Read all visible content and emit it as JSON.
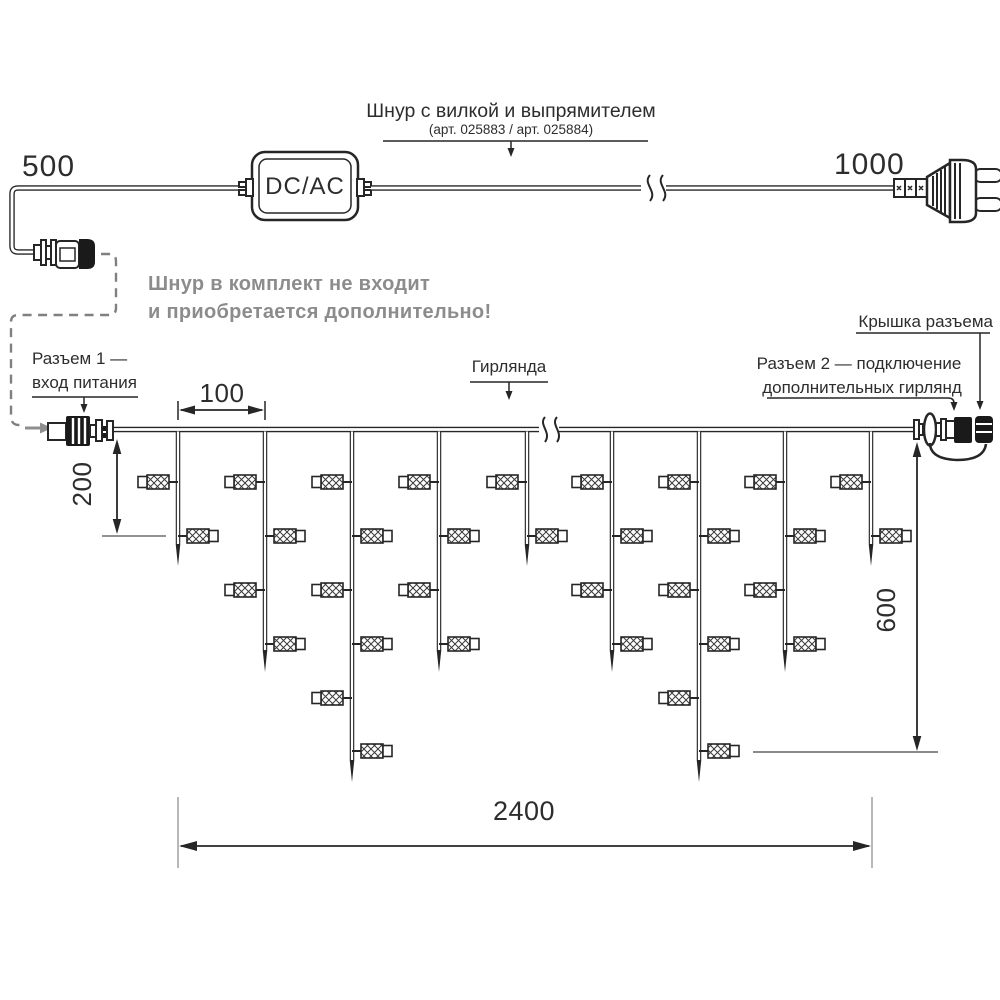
{
  "cord": {
    "dim_left": "500",
    "dim_right": "1000",
    "converter": "DC/AC",
    "title": "Шнур с вилкой и выпрямителем",
    "subtitle": "(арт. 025883 / арт. 025884)",
    "note_line1": "Шнур в комплект не входит",
    "note_line2": "и приобретается дополнительно!"
  },
  "garland": {
    "label": "Гирлянда",
    "connector1_line1": "Разъем 1 —",
    "connector1_line2": "вход питания",
    "connector2_line1": "Разъем 2 — подключение",
    "connector2_line2": "дополнительных гирлянд",
    "cap_label": "Крышка разъема",
    "dim_spacing": "100",
    "dim_drop_short": "200",
    "dim_drop_long": "600",
    "dim_total": "2400",
    "geometry": {
      "wire_y": 429.5,
      "wire_x1": 112,
      "wire_x2": 914,
      "bulb_rows": [
        482,
        536,
        590,
        644,
        698,
        751
      ],
      "drops": [
        {
          "x": 178,
          "tip": 566,
          "bulbs": 2
        },
        {
          "x": 265,
          "tip": 672,
          "bulbs": 4
        },
        {
          "x": 352,
          "tip": 782,
          "bulbs": 6
        },
        {
          "x": 439,
          "tip": 672,
          "bulbs": 4
        },
        {
          "x": 527,
          "tip": 566,
          "bulbs": 2
        },
        {
          "x": 612,
          "tip": 672,
          "bulbs": 4
        },
        {
          "x": 699,
          "tip": 782,
          "bulbs": 6
        },
        {
          "x": 785,
          "tip": 672,
          "bulbs": 4
        },
        {
          "x": 871,
          "tip": 566,
          "bulbs": 2
        }
      ]
    }
  },
  "colors": {
    "line": "#262626",
    "gray_text": "#8c8c8c",
    "gray_arrow": "#8f8f8f"
  }
}
